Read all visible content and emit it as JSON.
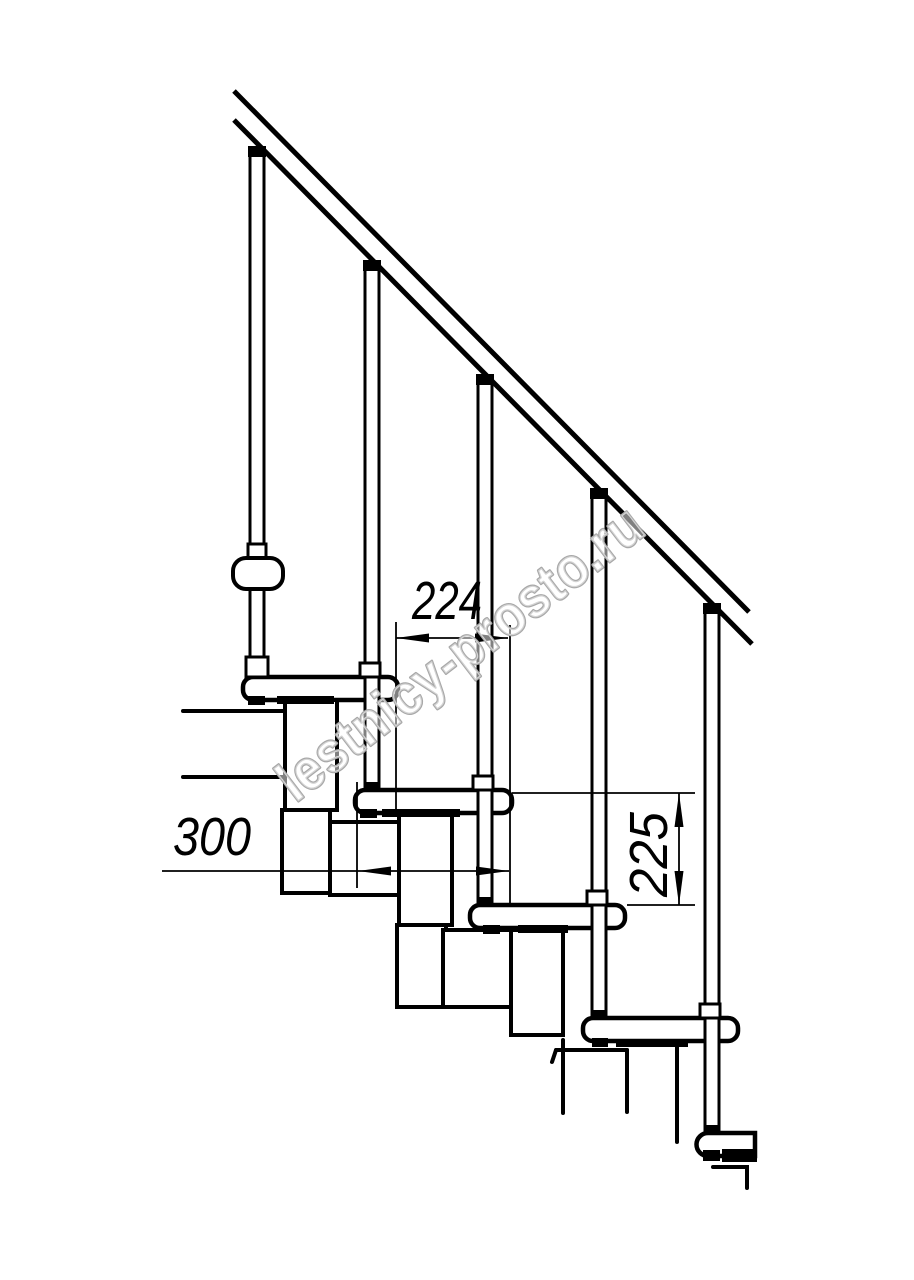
{
  "canvas": {
    "background": "#ffffff",
    "line_color": "#000000",
    "description": "Side-view technical drawing of a modular staircase section"
  },
  "watermark": {
    "text": "lestnicy-prosto.ru",
    "color": "#a8a8a8"
  },
  "dimensions": {
    "run": {
      "value": "224",
      "orientation": "horizontal"
    },
    "depth": {
      "value": "300",
      "orientation": "horizontal"
    },
    "rise": {
      "value": "225",
      "orientation": "vertical"
    }
  },
  "structure": {
    "treads": 5,
    "balusters": 5,
    "handrail_lines": 2
  }
}
